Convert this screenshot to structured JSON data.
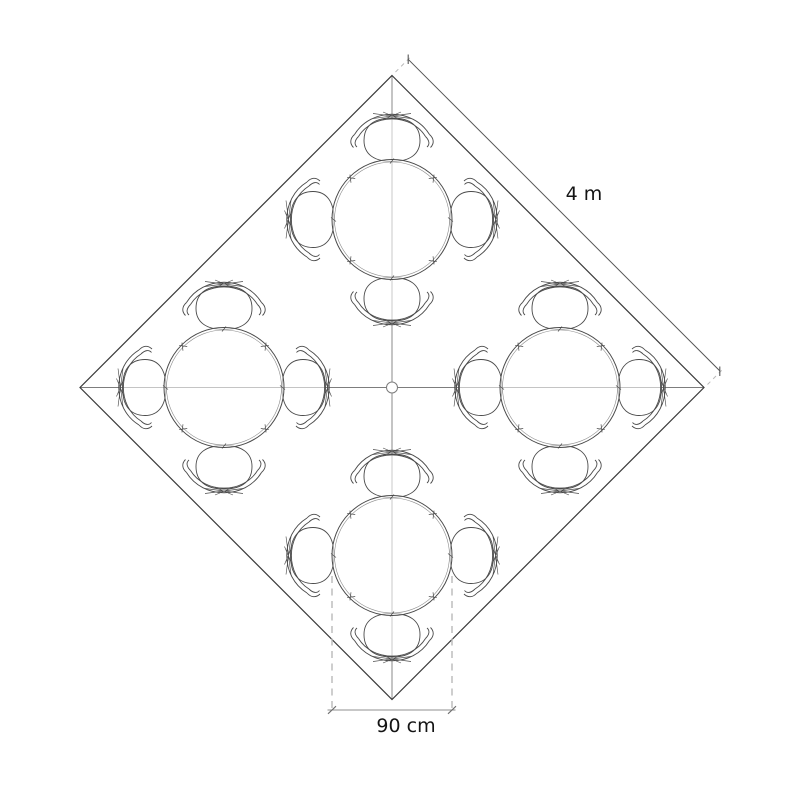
{
  "labels": {
    "side_dimension": "4 m",
    "table_dimension": "90 cm"
  },
  "plan": {
    "tables_count": 4,
    "chairs_per_table": 4
  },
  "colors": {
    "background": "#ffffff",
    "line_dark": "#3a3a3a",
    "line_furniture": "#4a4a4a",
    "line_mid": "#7d7d7d",
    "line_light": "#b9b9b9",
    "line_dim": "#8f8f8f",
    "text": "#141414"
  }
}
